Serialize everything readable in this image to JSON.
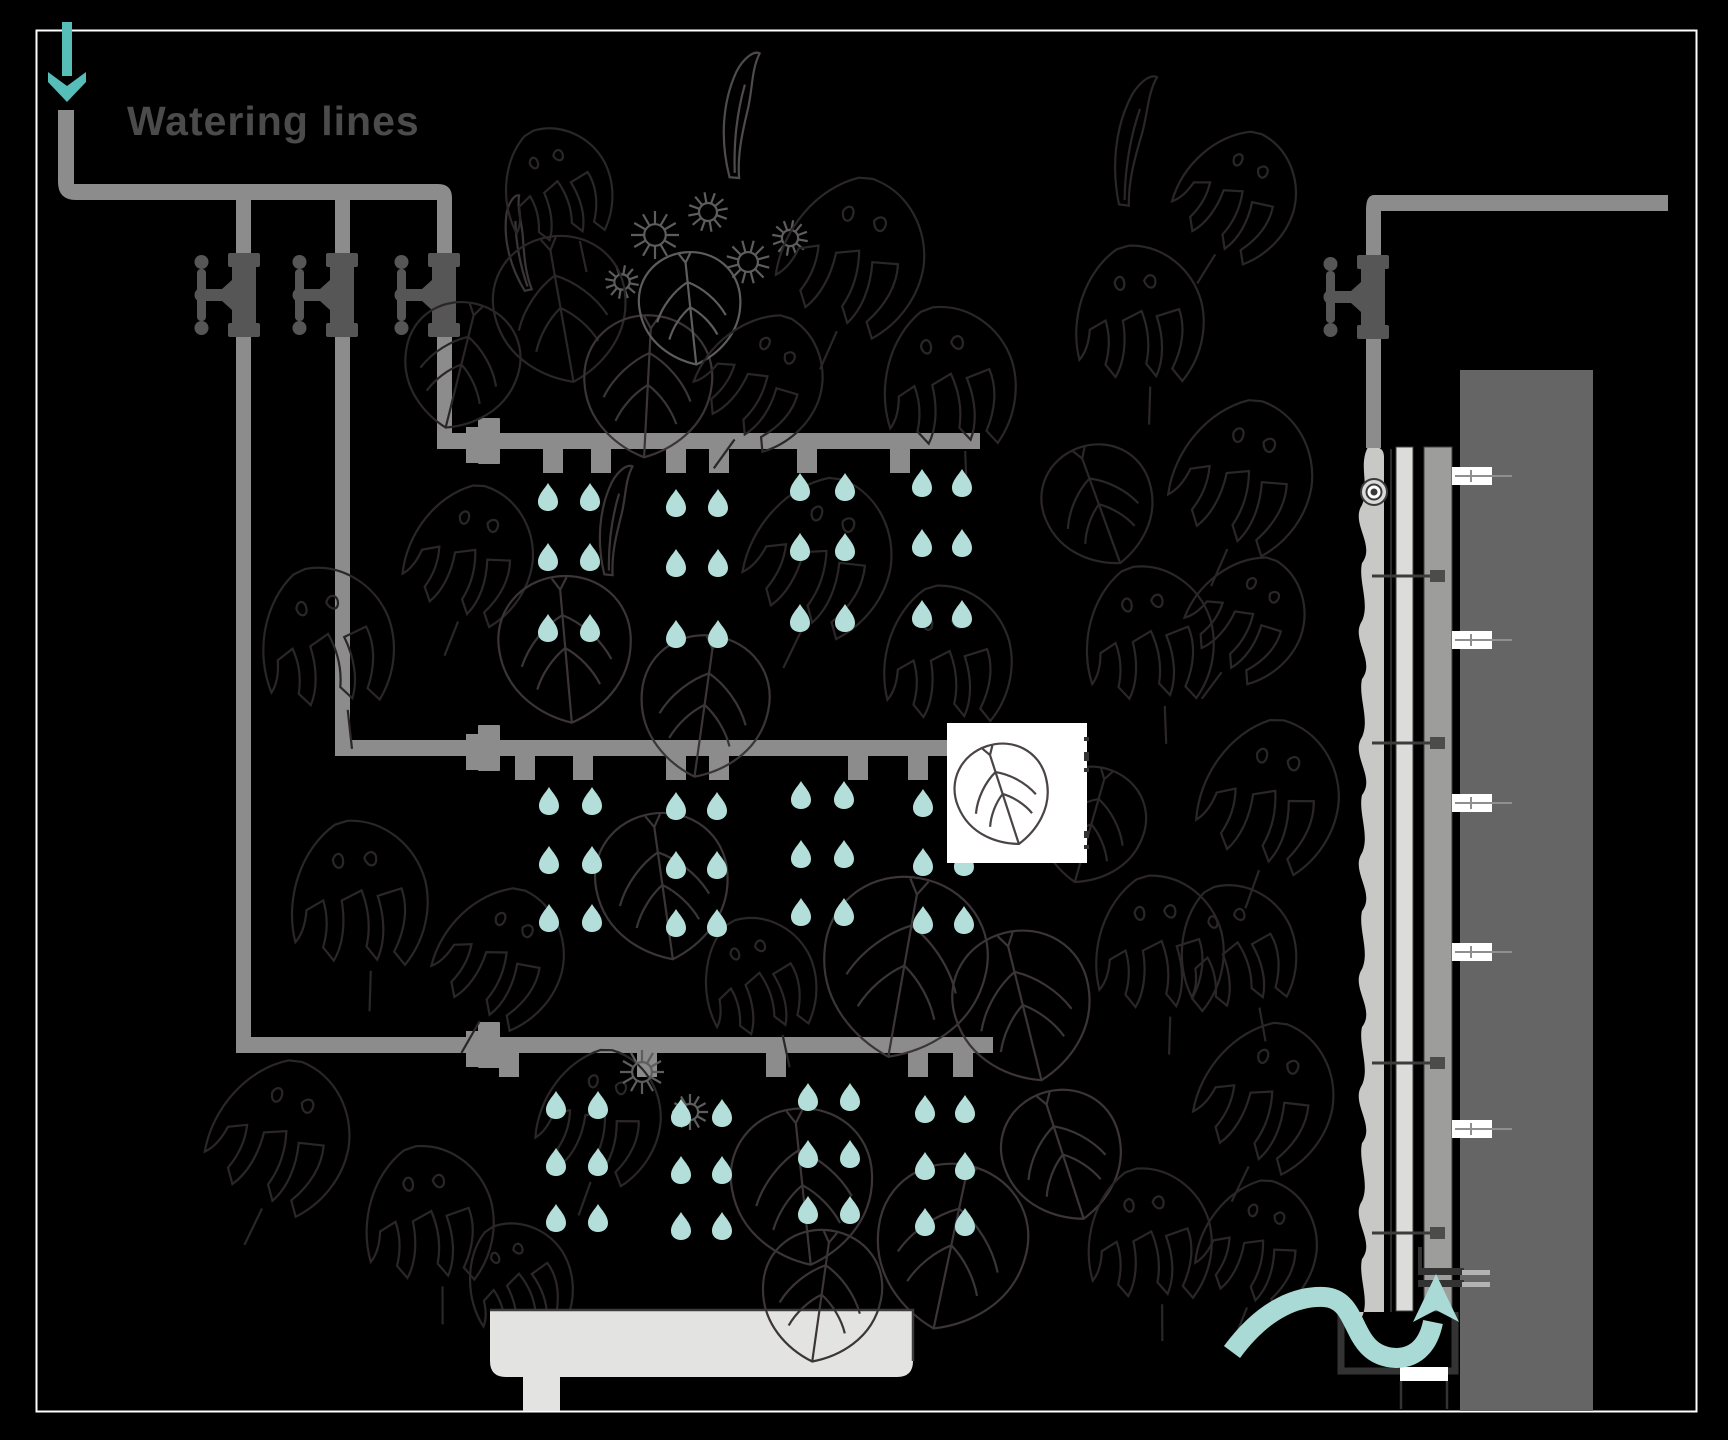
{
  "title": "Watering lines",
  "icons": {
    "inlet_arrow": "down-arrow-icon",
    "drain_arrow": "curved-up-arrow-icon",
    "valve": "tap-valve-icon",
    "droplet": "water-drop-icon"
  },
  "colors": {
    "background": "#000000",
    "frame": "#ffffff",
    "pipe": "#8c8c8c",
    "valve": "#565656",
    "droplet": "#b3ded9",
    "inlet_arrow": "#56bdb9",
    "drain_arrow": "#a9dad5",
    "text": "#4b4b4b",
    "trough": "#e3e3e2",
    "trough_outline": "#3c3c3c",
    "wall": "#656565",
    "panel_outer": "#9d9d9c",
    "panel_inner": "#dcdcdb",
    "mat": "#c8c8c7",
    "outline_dark": "#333333",
    "white": "#ffffff",
    "bolt_line": "#8f8f8f"
  },
  "foliage_colors": {
    "fd": "#2b2628",
    "fm": "#3b3537",
    "fl": "#4f4b4d",
    "fl2": "#5d5d5d",
    "sq": "#4a4446"
  },
  "front_view": {
    "inlet_arrow": {
      "x": 67,
      "shaft_top": 22,
      "tip_y": 102
    },
    "supply": {
      "pipe_w": 16,
      "v_x": 58,
      "v_top": 110,
      "h_y": 184,
      "h_x2": 452
    },
    "valve_cy": 295,
    "branches": [
      {
        "x": 236,
        "valve_cx": 244,
        "tier": 2
      },
      {
        "x": 335,
        "valve_cx": 342,
        "tier": 1
      },
      {
        "x": 437,
        "valve_cx": 444,
        "tier": 0
      }
    ],
    "tiers": [
      {
        "pipe_y": 433,
        "x1": 437,
        "x2": 980,
        "fitting_x": 466,
        "tabs": [
          553,
          601,
          676,
          719,
          807,
          900
        ],
        "pairs": [
          [
            548,
            590
          ],
          [
            676,
            718
          ],
          [
            800,
            845
          ],
          [
            922,
            962
          ]
        ],
        "rows": [
          497,
          557,
          628
        ],
        "pair_dy": [
          0,
          6,
          -10,
          -14
        ]
      },
      {
        "pipe_y": 740,
        "x1": 335,
        "x2": 960,
        "fitting_x": 466,
        "tabs": [
          525,
          583,
          676,
          719,
          858,
          918
        ],
        "pairs": [
          [
            549,
            592
          ],
          [
            676,
            717
          ],
          [
            801,
            844
          ],
          [
            923,
            964
          ]
        ],
        "rows": [
          801,
          860,
          918
        ],
        "pair_dy": [
          0,
          5,
          -6,
          2
        ]
      },
      {
        "pipe_y": 1037,
        "x1": 236,
        "x2": 993,
        "fitting_x": 466,
        "tabs": [
          509,
          647,
          776,
          918,
          963
        ],
        "pairs": [
          [
            556,
            598
          ],
          [
            681,
            722
          ],
          [
            808,
            850
          ],
          [
            925,
            965
          ]
        ],
        "rows": [
          1105,
          1162,
          1218
        ],
        "pair_dy": [
          0,
          8,
          -8,
          4
        ]
      }
    ],
    "white_square": {
      "x": 947,
      "y": 723,
      "w": 140,
      "h": 140,
      "edge_ticks": [
        [
          1084,
          737,
          5,
          4
        ],
        [
          1084,
          752,
          5,
          9
        ],
        [
          1084,
          768,
          5,
          4
        ],
        [
          1084,
          831,
          5,
          7
        ],
        [
          1084,
          845,
          5,
          4
        ]
      ]
    },
    "trough": {
      "x": 490,
      "y": 1310,
      "w": 423,
      "h": 67,
      "r": 16,
      "leg_x": 523,
      "leg_w": 37,
      "leg_h": 34
    }
  },
  "side_view": {
    "supply_pipe": {
      "h_y": 195,
      "h_x2": 1668,
      "v_x": 1366,
      "pipe_w": 15,
      "valve_cx": 1373,
      "valve_cy": 297,
      "v_bottom": 448
    },
    "emitter_circle": {
      "x": 1374,
      "y": 492
    },
    "wall": {
      "x": 1460,
      "y": 370,
      "w": 133,
      "h": 1041
    },
    "panel_outer": {
      "x": 1424,
      "y": 447,
      "w": 28,
      "h": 864
    },
    "panel_inner": {
      "x": 1396,
      "y": 447,
      "w": 17,
      "h": 864
    },
    "backing_line_x": 1391,
    "mat": {
      "x_left": 1356,
      "x_right": 1384,
      "y_top": 447,
      "y_bottom": 1312
    },
    "bolts_y": [
      476,
      640,
      803,
      952,
      1129
    ],
    "pins_y": [
      576,
      743,
      1063,
      1233
    ],
    "bracket": {
      "x": 1420,
      "y_top": 1247,
      "bars_y": [
        1268,
        1280
      ],
      "light_bars_y": [
        1270,
        1282
      ]
    },
    "drain": {
      "x1": 1341,
      "x2": 1455,
      "y_top": 1312,
      "y_bottom": 1371,
      "outlet": {
        "x": 1400,
        "y": 1367,
        "w": 48,
        "h": 14,
        "legs_bottom": 1409
      }
    },
    "flow_arrow": {
      "tail_x": 1232,
      "tail_y": 1352,
      "head_tip": [
        1436,
        1274
      ],
      "head_base_y": 1322
    }
  },
  "foliage": [
    [
      "flame",
      735,
      115,
      1.2,
      5,
      "fl"
    ],
    [
      "flame",
      515,
      245,
      0.9,
      -12,
      "fm"
    ],
    [
      "spiky",
      655,
      235,
      1.2,
      0,
      "fl2"
    ],
    [
      "spiky",
      708,
      212,
      1.0,
      20,
      "fl2"
    ],
    [
      "spiky",
      748,
      262,
      1.1,
      -15,
      "fl2"
    ],
    [
      "spiky",
      622,
      282,
      0.85,
      40,
      "fl2"
    ],
    [
      "spiky",
      790,
      238,
      0.9,
      10,
      "fl2"
    ],
    [
      "heart",
      560,
      305,
      1.5,
      -10,
      "fd"
    ],
    [
      "heart",
      462,
      362,
      1.3,
      14,
      "fd"
    ],
    [
      "heart",
      648,
      382,
      1.45,
      3,
      "fm"
    ],
    [
      "heart",
      690,
      305,
      1.15,
      -6,
      "fl2"
    ],
    [
      "monstera",
      855,
      262,
      1.7,
      12,
      "fd"
    ],
    [
      "monstera",
      952,
      385,
      1.6,
      -14,
      "fd"
    ],
    [
      "monstera",
      762,
      385,
      1.45,
      24,
      "fd"
    ],
    [
      "monstera",
      560,
      190,
      1.3,
      -24,
      "fd"
    ],
    [
      "monstera",
      330,
      645,
      1.6,
      -18,
      "fd"
    ],
    [
      "monstera",
      472,
      560,
      1.5,
      10,
      "fd"
    ],
    [
      "heart",
      565,
      645,
      1.5,
      -5,
      "fm"
    ],
    [
      "flame",
      610,
      520,
      1.05,
      6,
      "fm"
    ],
    [
      "monstera",
      822,
      562,
      1.7,
      14,
      "fd"
    ],
    [
      "monstera",
      950,
      662,
      1.55,
      -10,
      "fd"
    ],
    [
      "heart",
      705,
      702,
      1.45,
      8,
      "fm"
    ],
    [
      "monstera",
      362,
      902,
      1.65,
      -10,
      "fd"
    ],
    [
      "monstera",
      502,
      962,
      1.5,
      18,
      "fd"
    ],
    [
      "heart",
      662,
      882,
      1.5,
      -8,
      "fm"
    ],
    [
      "heart",
      905,
      962,
      1.85,
      10,
      "fm"
    ],
    [
      "heart",
      1022,
      1002,
      1.55,
      -14,
      "fm"
    ],
    [
      "monstera",
      762,
      982,
      1.35,
      -24,
      "fd"
    ],
    [
      "monstera",
      282,
      1142,
      1.65,
      14,
      "fd"
    ],
    [
      "monstera",
      432,
      1222,
      1.55,
      -12,
      "fd"
    ],
    [
      "monstera",
      602,
      1122,
      1.45,
      8,
      "fd"
    ],
    [
      "spiky",
      642,
      1072,
      1.1,
      0,
      "fl2"
    ],
    [
      "spiky",
      690,
      1112,
      0.9,
      30,
      "fl2"
    ],
    [
      "heart",
      802,
      1182,
      1.6,
      -6,
      "fm"
    ],
    [
      "heart",
      952,
      1242,
      1.7,
      12,
      "fm"
    ],
    [
      "heart",
      1062,
      1152,
      1.35,
      -18,
      "fm"
    ],
    [
      "monstera",
      522,
      1282,
      1.25,
      -28,
      "fd"
    ],
    [
      "flame",
      1128,
      140,
      1.25,
      8,
      "fd"
    ],
    [
      "monstera",
      1142,
      322,
      1.55,
      -10,
      "fd"
    ],
    [
      "monstera",
      1238,
      200,
      1.4,
      20,
      "fd"
    ],
    [
      "monstera",
      1245,
      482,
      1.65,
      12,
      "fd"
    ],
    [
      "heart",
      1098,
      502,
      1.25,
      -20,
      "fd"
    ],
    [
      "monstera",
      1152,
      642,
      1.55,
      -14,
      "fd"
    ],
    [
      "monstera",
      1248,
      622,
      1.35,
      25,
      "fd"
    ],
    [
      "monstera",
      1272,
      802,
      1.65,
      8,
      "fd"
    ],
    [
      "heart",
      1092,
      822,
      1.2,
      16,
      "fd"
    ],
    [
      "monstera",
      1162,
      952,
      1.55,
      -10,
      "fd"
    ],
    [
      "monstera",
      1240,
      952,
      1.4,
      -22,
      "fd"
    ],
    [
      "monstera",
      1268,
      1102,
      1.6,
      14,
      "fd"
    ],
    [
      "monstera",
      1152,
      1242,
      1.5,
      -12,
      "fd"
    ],
    [
      "monstera",
      1260,
      1250,
      1.4,
      10,
      "fd"
    ]
  ],
  "foliage_overlay": [
    [
      "heart",
      1002,
      792,
      1.05,
      -18,
      "sq"
    ],
    [
      "heart",
      822,
      1292,
      1.35,
      8,
      "fm"
    ]
  ]
}
